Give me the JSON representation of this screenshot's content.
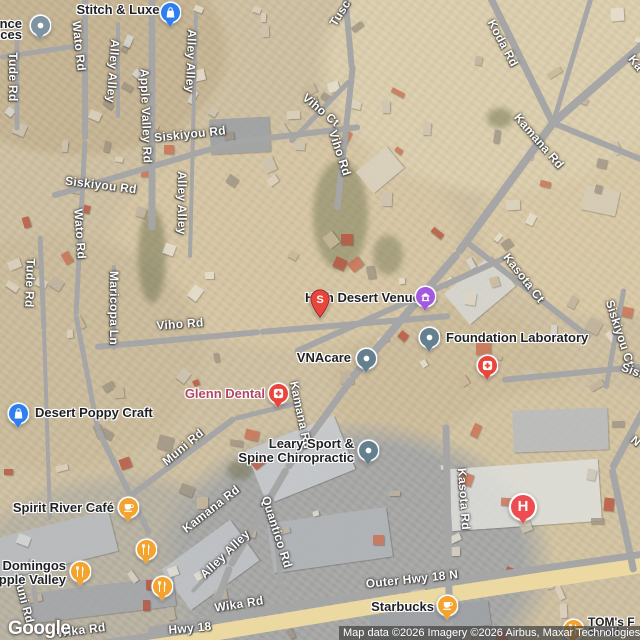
{
  "map": {
    "google_logo": "Google",
    "attribution": "Map data ©2026 Imagery ©2026 Airbus, Maxar Technologies",
    "colors": {
      "blue": "#2d7ff0",
      "purple": "#a358e0",
      "red": "#e8453c",
      "hospital_red": "#ed4c50",
      "orange": "#f3a32e",
      "slate": "#64808f",
      "gray_marker": "#7f93a0",
      "health_label": "#b04766",
      "road": "#a6a6a6",
      "highway": "#ecd9a2"
    },
    "road_labels": [
      {
        "text": "Tude Rd",
        "x": 13,
        "y": 77,
        "rot": 90
      },
      {
        "text": "Wato Rd",
        "x": 79,
        "y": 46,
        "rot": 84
      },
      {
        "text": "Alley Alley",
        "x": 113,
        "y": 71,
        "rot": 94
      },
      {
        "text": "Alley Alley",
        "x": 191,
        "y": 61,
        "rot": 92
      },
      {
        "text": "Apple Valley Rd",
        "x": 146,
        "y": 116,
        "rot": 88
      },
      {
        "text": "Siskiyou Rd",
        "x": 190,
        "y": 134,
        "rot": -6
      },
      {
        "text": "Tusc",
        "x": 340,
        "y": 13,
        "rot": -58
      },
      {
        "text": "Viho Ct",
        "x": 321,
        "y": 110,
        "rot": 40
      },
      {
        "text": "Viho Rd",
        "x": 340,
        "y": 153,
        "rot": 72
      },
      {
        "text": "Koda Rd",
        "x": 503,
        "y": 43,
        "rot": 62
      },
      {
        "text": "Kamana Rd",
        "x": 539,
        "y": 141,
        "rot": 49
      },
      {
        "text": "Ka",
        "x": 636,
        "y": 63,
        "rot": 52
      },
      {
        "text": "Siskiyou Rd",
        "x": 101,
        "y": 185,
        "rot": 7
      },
      {
        "text": "Wato Rd",
        "x": 80,
        "y": 234,
        "rot": 86
      },
      {
        "text": "Tude Rd",
        "x": 30,
        "y": 283,
        "rot": 92
      },
      {
        "text": "Alley Alley",
        "x": 182,
        "y": 203,
        "rot": 90
      },
      {
        "text": "Maricopa Ln",
        "x": 114,
        "y": 308,
        "rot": 90
      },
      {
        "text": "Viho Rd",
        "x": 180,
        "y": 324,
        "rot": -4
      },
      {
        "text": "Kasota Ct",
        "x": 524,
        "y": 278,
        "rot": 52
      },
      {
        "text": "Siskiyou Ct",
        "x": 620,
        "y": 333,
        "rot": 72
      },
      {
        "text": "Sisk",
        "x": 634,
        "y": 371,
        "rot": 20
      },
      {
        "text": "Kamana Rd",
        "x": 301,
        "y": 415,
        "rot": 78
      },
      {
        "text": "Muni Rd",
        "x": 183,
        "y": 447,
        "rot": -40
      },
      {
        "text": "Kamana Rd",
        "x": 211,
        "y": 509,
        "rot": -38
      },
      {
        "text": "Quantico Rd",
        "x": 277,
        "y": 532,
        "rot": 72
      },
      {
        "text": "Alley Alley",
        "x": 225,
        "y": 554,
        "rot": -44
      },
      {
        "text": "Kasota Rd",
        "x": 464,
        "y": 499,
        "rot": 86
      },
      {
        "text": "Outer Hwy 18 N",
        "x": 412,
        "y": 579,
        "rot": -6
      },
      {
        "text": "Wika Rd",
        "x": 239,
        "y": 604,
        "rot": -9
      },
      {
        "text": "Hwy 18",
        "x": 190,
        "y": 628,
        "rot": -5
      },
      {
        "text": "Wika Rd",
        "x": 81,
        "y": 630,
        "rot": -7
      },
      {
        "text": "Muni Rd",
        "x": 24,
        "y": 599,
        "rot": 75
      },
      {
        "text": "N",
        "x": 636,
        "y": 441,
        "rot": 40
      }
    ],
    "poi_labels": [
      {
        "id": "partial-business",
        "lines": [
          "ance",
          "ices"
        ],
        "anchor": "right",
        "x": 22,
        "y": 29,
        "lh": 11.5
      },
      {
        "id": "stitch-and-luxe",
        "lines": [
          "Stitch & Luxe"
        ],
        "anchor": "center",
        "x": 118,
        "y": 10
      },
      {
        "id": "high-desert-venues",
        "lines": [
          "High Desert Venues"
        ],
        "anchor": "center",
        "x": 366,
        "y": 298
      },
      {
        "id": "foundation-laboratory",
        "lines": [
          "Foundation Laboratory"
        ],
        "anchor": "left",
        "x": 446,
        "y": 338
      },
      {
        "id": "vnacare",
        "lines": [
          "VNAcare"
        ],
        "anchor": "right",
        "x": 351,
        "y": 358
      },
      {
        "id": "glenn-dental",
        "lines": [
          "Glenn Dental"
        ],
        "anchor": "right",
        "x": 265,
        "y": 394,
        "colorKey": "health_label"
      },
      {
        "id": "desert-poppy-craft",
        "lines": [
          "Desert Poppy Craft"
        ],
        "anchor": "left",
        "x": 35,
        "y": 413
      },
      {
        "id": "leary-sport-spine-chiropractic",
        "lines": [
          "Leary Sport &",
          "Spine Chiropractic"
        ],
        "anchor": "right",
        "x": 354,
        "y": 451
      },
      {
        "id": "spirit-river-cafe",
        "lines": [
          "Spirit River Café"
        ],
        "anchor": "right",
        "x": 114,
        "y": 508
      },
      {
        "id": "domingos-apple-valley",
        "lines": [
          "Domingos",
          "Apple Valley"
        ],
        "anchor": "right",
        "x": 66,
        "y": 573
      },
      {
        "id": "starbucks",
        "lines": [
          "Starbucks"
        ],
        "anchor": "right",
        "x": 434,
        "y": 607
      },
      {
        "id": "toms-partial",
        "lines": [
          "TOM's F",
          "Famil"
        ],
        "anchor": "left",
        "x": 588,
        "y": 627,
        "lh": 10,
        "fs": 12
      }
    ],
    "markers": [
      {
        "name": "generic-place-marker",
        "icon": "place-dot",
        "colorKey": "gray_marker",
        "x": 40,
        "y": 25
      },
      {
        "name": "stitch-and-luxe-marker",
        "icon": "shopping-bag",
        "colorKey": "blue",
        "x": 170,
        "y": 12
      },
      {
        "name": "search-result-pin",
        "icon": "pin-letter",
        "letter": "S",
        "colorKey": "red",
        "x": 320,
        "y": 318
      },
      {
        "name": "high-desert-venues-marker",
        "icon": "venue",
        "colorKey": "purple",
        "x": 425,
        "y": 296
      },
      {
        "name": "foundation-laboratory-marker",
        "icon": "place-dot",
        "colorKey": "slate",
        "x": 429,
        "y": 337
      },
      {
        "name": "vnacare-marker",
        "icon": "place-dot",
        "colorKey": "slate",
        "x": 366,
        "y": 358
      },
      {
        "name": "glenn-dental-marker",
        "icon": "med-cross",
        "colorKey": "red",
        "x": 278,
        "y": 393
      },
      {
        "name": "medical-marker",
        "icon": "med-cross",
        "colorKey": "red",
        "x": 487,
        "y": 365
      },
      {
        "name": "leary-chiropractic-marker",
        "icon": "place-dot",
        "colorKey": "slate",
        "x": 368,
        "y": 450
      },
      {
        "name": "desert-poppy-craft-marker",
        "icon": "shopping-bag",
        "colorKey": "blue",
        "x": 18,
        "y": 413
      },
      {
        "name": "spirit-river-cafe-marker",
        "icon": "coffee-cup",
        "colorKey": "orange",
        "x": 128,
        "y": 507
      },
      {
        "name": "restaurant-marker",
        "icon": "fork-knife",
        "colorKey": "orange",
        "x": 146,
        "y": 549
      },
      {
        "name": "domingos-marker",
        "icon": "fork-knife",
        "colorKey": "orange",
        "x": 80,
        "y": 571
      },
      {
        "name": "restaurant-marker",
        "icon": "fork-knife",
        "colorKey": "orange",
        "x": 162,
        "y": 586
      },
      {
        "name": "hospital-marker",
        "icon": "hospital-h",
        "letter": "H",
        "colorKey": "hospital_red",
        "x": 523,
        "y": 507,
        "size": 24
      },
      {
        "name": "starbucks-marker",
        "icon": "coffee-cup",
        "colorKey": "orange",
        "x": 447,
        "y": 605
      },
      {
        "name": "toms-marker",
        "icon": "fork-knife",
        "colorKey": "orange",
        "x": 573,
        "y": 629
      }
    ]
  }
}
